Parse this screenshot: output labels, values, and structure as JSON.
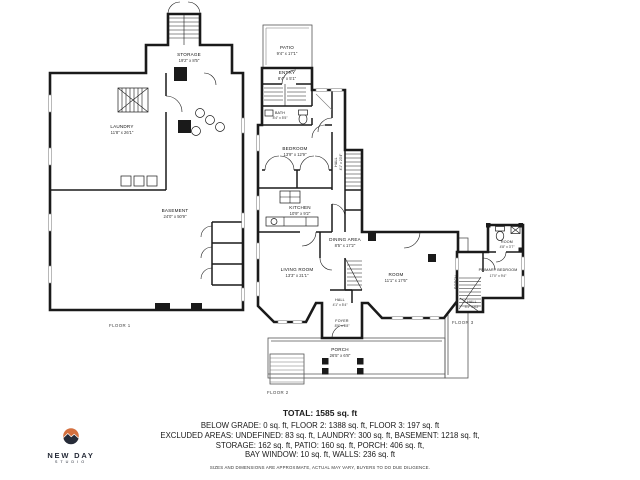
{
  "colors": {
    "wall": "#1a1a1a",
    "sun_top": "#d4703f",
    "sun_bottom": "#262b38"
  },
  "logo": {
    "title": "NEW DAY",
    "subtitle": "STUDIO"
  },
  "plans": {
    "floor1": {
      "caption": "FLOOR 1",
      "rooms": {
        "storage": {
          "name": "STORAGE",
          "dims": "19'2\" x 8'5\""
        },
        "laundry": {
          "name": "LAUNDRY",
          "dims": "11'8\" x 26'1\""
        },
        "basement": {
          "name": "BASEMENT",
          "dims": "24'0\" x 50'9\""
        }
      }
    },
    "floor2": {
      "caption": "FLOOR 2",
      "rooms": {
        "patio": {
          "name": "PATIO",
          "dims": "9'4\" x 17'1\""
        },
        "entry": {
          "name": "ENTRY",
          "dims": "8'4\" x 5'1\""
        },
        "bath": {
          "name": "BATH",
          "dims": "8'4\" x 5'5\""
        },
        "bedroom": {
          "name": "BEDROOM",
          "dims": "13'9\" x 12'9\""
        },
        "hall_upper": {
          "name": "HALL",
          "dims": "4'1\" x 23'4\""
        },
        "kitchen": {
          "name": "KITCHEN",
          "dims": "10'9\" x 9'2\""
        },
        "dining": {
          "name": "DINING AREA",
          "dims": "8'5\" x 17'2\""
        },
        "living": {
          "name": "LIVING ROOM",
          "dims": "13'3\" x 21'1\""
        },
        "room": {
          "name": "ROOM",
          "dims": "11'1\" x 17'6\""
        },
        "hall_lower": {
          "name": "HALL",
          "dims": "4'1\" x 5'4\""
        },
        "foyer": {
          "name": "FOYER",
          "dims": "8'5\" x 6'8\""
        },
        "porch": {
          "name": "PORCH",
          "dims": "26'5\" x 6'8\""
        },
        "porch_side": {
          "name": "PORCH",
          "dims": "4'5\" x 12'10\""
        }
      }
    },
    "floor3": {
      "caption": "FLOOR 3",
      "rooms": {
        "room": {
          "name": "ROOM",
          "dims": "4'8\" x 3'7\""
        },
        "primary": {
          "name": "PRIMARY BEDROOM",
          "dims": "17'0\" x 9'4\""
        },
        "hall": {
          "name": "HALL",
          "dims": "3'1\" x 4'2\""
        }
      }
    }
  },
  "summary": {
    "total": "TOTAL: 1585 sq. ft",
    "line1": "BELOW GRADE: 0 sq. ft, FLOOR 2: 1388 sq. ft, FLOOR 3: 197 sq. ft",
    "line2": "EXCLUDED AREAS: UNDEFINED: 83 sq. ft, LAUNDRY: 300 sq. ft, BASEMENT: 1218 sq. ft,",
    "line3": "STORAGE: 162 sq. ft, PATIO: 160 sq. ft, PORCH: 406 sq. ft,",
    "line4": "BAY WINDOW: 10 sq. ft, WALLS: 236 sq. ft",
    "disclaimer": "SIZES AND DIMENSIONS ARE APPROXIMATE, ACTUAL MAY VARY, BUYERS TO DO DUE DILIGENCE."
  }
}
